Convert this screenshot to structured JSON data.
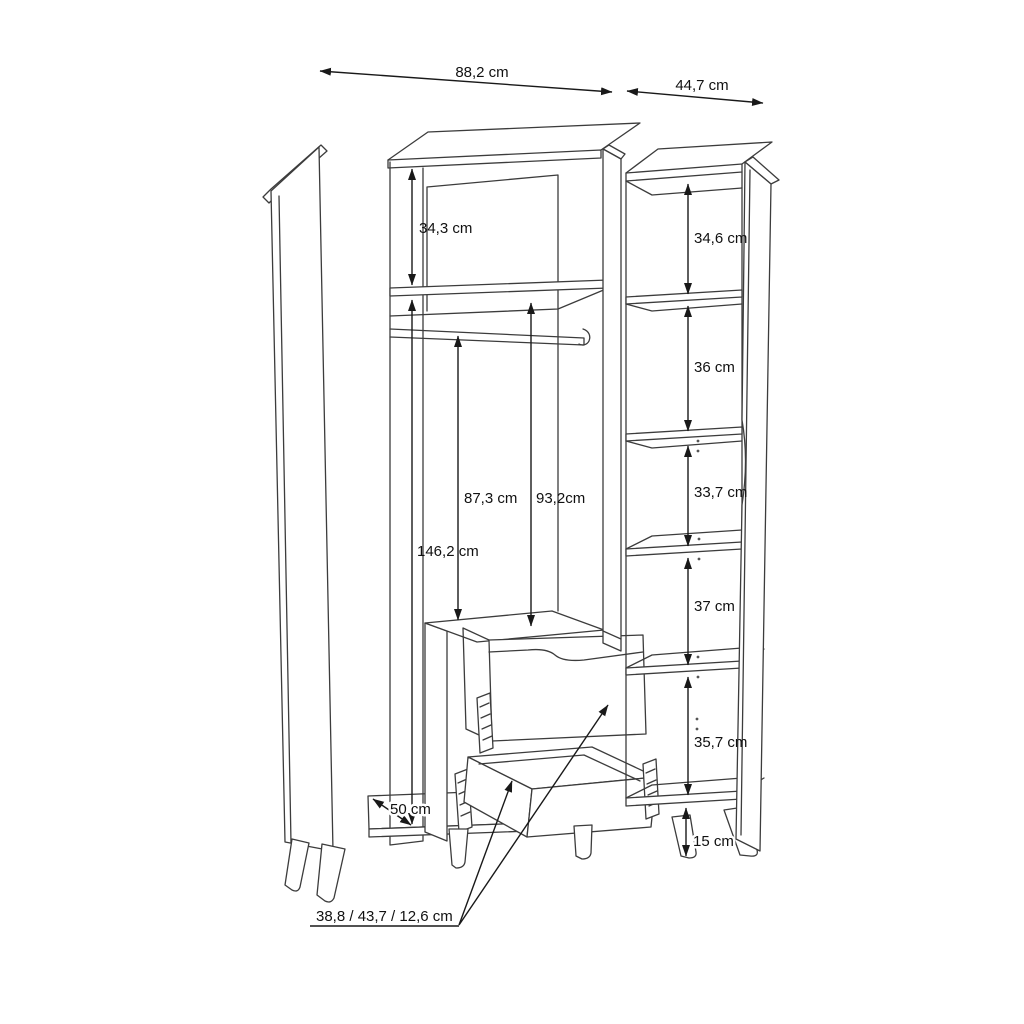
{
  "diagram": {
    "subject": "wardrobe-technical-dimension-drawing",
    "unit": "cm"
  },
  "labels": {
    "width_main": "88,2 cm",
    "width_right": "44,7 cm",
    "top_compartment": "34,3 cm",
    "interior_height": "146,2 cm",
    "rail_height": "87,3 cm",
    "shelf_height": "93,2cm",
    "depth": "50 cm",
    "right_shelves": [
      "34,6 cm",
      "36 cm",
      "33,7 cm",
      "37 cm",
      "35,7 cm"
    ],
    "leg_height": "15 cm",
    "drawer_dimensions": "38,8 / 43,7 / 12,6 cm"
  },
  "colors": {
    "background": "#ffffff",
    "structure_line": "#3c3c3c",
    "dimension_line": "#191919",
    "text": "#111111"
  }
}
